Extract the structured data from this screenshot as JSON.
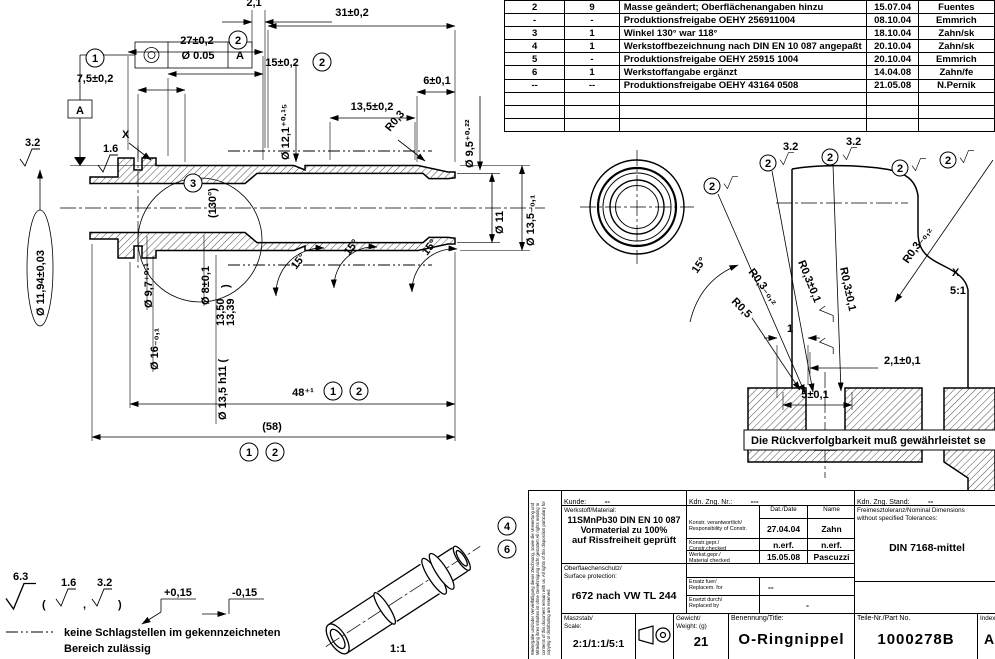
{
  "drawing": {
    "gdt": {
      "tolerance": "Ø 0.05",
      "datum": "A"
    },
    "balloons": {
      "b1": "1",
      "b2": "2",
      "b3": "3",
      "b4": "4",
      "b6": "6"
    },
    "dims": {
      "top_2_1": "2,1",
      "len_31": "31±0,2",
      "len_27": "27±0,2",
      "len_15": "15±0,2",
      "len_7_5": "7,5±0,2",
      "len_6": "6±0,1",
      "len_13_5": "13,5±0,2",
      "r0_3": "R0,3",
      "dia_12_1": "Ø 12,1⁺⁰·¹⁵",
      "dia_9_5": "Ø 9,5⁺⁰·²²",
      "dia_11": "Ø 11",
      "dia_13_5_tol": "Ø 13,5₋₀,₁",
      "dia_11_94": "Ø 11,94±0,03",
      "dia_9_7": "Ø 9,7⁺⁰·¹",
      "dia_8": "Ø 8±0,1",
      "dia_16": "Ø 16₋₀,₁",
      "dia_13_5_h11": "Ø 13,5 h11 (",
      "h11_max": "13,50",
      "h11_min": "13,39",
      "paren_close": ")",
      "len_48": "48⁺¹",
      "len_58": "(58)",
      "angle_130": "(130°)",
      "angle_15": "15°"
    },
    "marks": {
      "datum_a": "A",
      "x_ref": "X",
      "sf_32": "3.2",
      "sf_16": "1.6",
      "sf_63": "6.3"
    },
    "detail": {
      "r03_minus": "R0,3₋₀,₂",
      "r03_pm": "R0,3±0,1",
      "x": "X",
      "scale": "5:1",
      "r05": "R0,5",
      "dim_1": "1",
      "dim_2_1": "2,1±0,1",
      "dim_5": "5±0,1",
      "angle_15": "15°",
      "sf_32": "3.2"
    },
    "iso_scale": "1:1",
    "notes": {
      "traceability": "Die Rückverfolgbarkeit muß gewährleistet se",
      "paren_open": "(",
      "paren_close": ")",
      "comma": ",",
      "edge_plus": "+0,15",
      "edge_minus": "-0,15",
      "impact_line1": "keine Schlagstellen im gekennzeichneten",
      "impact_line2": "Bereich zulässig"
    }
  },
  "revision_table": {
    "rows": [
      {
        "rev": "2",
        "count": "9",
        "description": "Masse geändert; Oberflächenangaben hinzu",
        "date": "15.07.04",
        "name": "Fuentes"
      },
      {
        "rev": "-",
        "count": "-",
        "description": "Produktionsfreigabe OEHY 256911004",
        "date": "08.10.04",
        "name": "Emmrich"
      },
      {
        "rev": "3",
        "count": "1",
        "description": "Winkel 130° war 118°",
        "date": "18.10.04",
        "name": "Zahn/sk"
      },
      {
        "rev": "4",
        "count": "1",
        "description": "Werkstoffbezeichnung nach DIN EN 10 087 angepaßt",
        "date": "20.10.04",
        "name": "Zahn/sk"
      },
      {
        "rev": "5",
        "count": "-",
        "description": "Produktionsfreigabe OEHY 25915 1004",
        "date": "20.10.04",
        "name": "Emmrich"
      },
      {
        "rev": "6",
        "count": "1",
        "description": "Werkstoffangabe ergänzt",
        "date": "14.04.08",
        "name": "Zahn/fe"
      },
      {
        "rev": "--",
        "count": "--",
        "description": "Produktionsfreigabe OEHY 43164 0508",
        "date": "21.05.08",
        "name": "N.Pernik"
      }
    ]
  },
  "title_block": {
    "kunde_label": "Kunde:",
    "kunde_value": "--",
    "kdn_nr_label": "Kdn. Zng. Nr.:",
    "kdn_nr_value": "---",
    "kdn_stand_label": "Kdn. Zng. Stand:",
    "kdn_stand_value": "--",
    "material_label": "Werkstoff/Material:",
    "material_line1": "11SMnPb30  DIN EN 10 087",
    "material_line2": "Vormaterial zu 100%",
    "material_line3": "auf Rissfreiheit geprüft",
    "date_header": "Dat./Date",
    "name_header": "Name",
    "row_resp_label1": "Konstr. verantwortlich/",
    "row_resp_label2": "Responsibility of Constr.",
    "row_resp_date": "27.04.04",
    "row_resp_name": "Zahn",
    "row_constr_label1": "Konstr.gepr./",
    "row_constr_label2": "Constr.checked",
    "row_constr_date": "n.erf.",
    "row_constr_name": "n.erf.",
    "row_mat_label1": "Werkst.gepr./",
    "row_mat_label2": "Material checked",
    "row_mat_date": "15.05.08",
    "row_mat_name": "Pascuzzi",
    "tolerance_label1": "Freimesztoleranz/Nominal Dimensions",
    "tolerance_label2": "without specified Tolerances:",
    "tolerance_value": "DIN 7168-mittel",
    "surface_label1": "Oberflaechenschutz/",
    "surface_label2": "Surface protection:",
    "surface_value": "r672 nach VW TL 244",
    "ersatz_label1": "Ersatz fuer/",
    "ersatz_label2": "Replacem. for",
    "ersatz_value": "--",
    "ersetzt_label1": "Ersetzt durch/",
    "ersetzt_label2": "Replaced by",
    "ersetzt_value": "-",
    "scale_label1": "Maszstab/",
    "scale_label2": "Scale:",
    "scale_value": "2:1/1:1/5:1",
    "weight_label1": "Gewicht/",
    "weight_label2": "Weight:  (g)",
    "weight_value": "21",
    "title_label": "Benennung/Title:",
    "title_value": "O-Ringnippel",
    "part_no_label": "Teile-Nr./Part No.",
    "part_no_value": "1000278B",
    "index_label": "Index:",
    "index_value": "A",
    "copyright": "Weitergabe und/oder Vervielfältigung dieser Zeichnung, sowie die Verwertung und Mitteilung ihres Inhaltes ist ohne Genehmigung nicht gestattet! All rights relating to contents of this document remain with us. All rights of this disposition particulary for copying or distributing are reserved."
  },
  "colors": {
    "line": "#000000",
    "background": "#ffffff"
  }
}
